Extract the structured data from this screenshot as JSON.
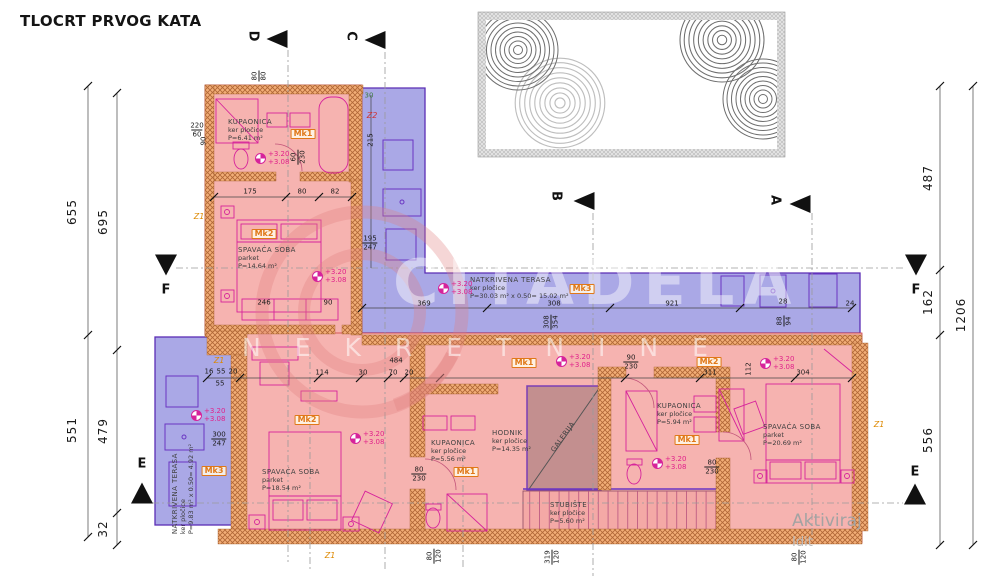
{
  "title": "TLOCRT PRVOG KATA",
  "watermark": {
    "brand": "CITADELA",
    "sub": "NEKRETNINE"
  },
  "activation": {
    "line1": "Aktiviraj",
    "line2": "Idit"
  },
  "elevation": {
    "top": "+3.20",
    "bottom": "+3.08"
  },
  "colors": {
    "room_fill": "#f6b3b0",
    "terrace_fill": "#aaa8e6",
    "wall_fill": "#f2ae77",
    "wall_line": "#b06636",
    "accent_magenta": "#d6239b",
    "accent_purple": "#6a35c2",
    "label_orange": "#e07818",
    "dim_green": "#3f7d3f",
    "gallery_fill": "#c38f8f"
  },
  "rooms": [
    {
      "x": 228,
      "y": 118,
      "lines": [
        "KUPAONICA",
        "ker pločice",
        "P=6.41 m²"
      ]
    },
    {
      "x": 238,
      "y": 246,
      "lines": [
        "SPAVAĆA SOBA",
        "parket",
        "P=14.64 m²"
      ]
    },
    {
      "x": 470,
      "y": 276,
      "lines": [
        "NATKRIVENA TERASA",
        "ker pločice",
        "P=30.03 m² x 0.50= 15.02 m²"
      ]
    },
    {
      "x": 183,
      "y": 489,
      "rot": -90,
      "anchor": "c",
      "lines": [
        "NATKRIVENA TERASA",
        "ker pločice",
        "P=9.83 m² x 0.50= 4.92 m²"
      ]
    },
    {
      "x": 262,
      "y": 468,
      "lines": [
        "SPAVAĆA SOBA",
        "parket",
        "P=18.54 m²"
      ]
    },
    {
      "x": 431,
      "y": 439,
      "lines": [
        "KUPAONICA",
        "ker pločice",
        "P=5.56 m²"
      ]
    },
    {
      "x": 492,
      "y": 429,
      "lines": [
        "HODNIK",
        "ker pločice",
        "P=14.35 m²"
      ]
    },
    {
      "x": 550,
      "y": 501,
      "lines": [
        "STUBIŠTE",
        "ker pločice",
        "P=5.60 m²"
      ]
    },
    {
      "x": 657,
      "y": 402,
      "lines": [
        "KUPAONICA",
        "ker pločice",
        "P=5.94 m²"
      ]
    },
    {
      "x": 763,
      "y": 423,
      "lines": [
        "SPAVAĆA SOBA",
        "parket",
        "P=20.69 m²"
      ]
    },
    {
      "x": 563,
      "y": 437,
      "rot": -54,
      "anchor": "c",
      "cls": "gal",
      "lines": [
        "GALERIJA"
      ]
    }
  ],
  "mk_labels": [
    {
      "t": "Mk1",
      "x": 303,
      "y": 134
    },
    {
      "t": "Mk2",
      "x": 264,
      "y": 234
    },
    {
      "t": "Mk3",
      "x": 582,
      "y": 289
    },
    {
      "t": "Mk3",
      "x": 214,
      "y": 471
    },
    {
      "t": "Mk2",
      "x": 307,
      "y": 420
    },
    {
      "t": "Mk1",
      "x": 466,
      "y": 472
    },
    {
      "t": "Mk1",
      "x": 524,
      "y": 363
    },
    {
      "t": "Mk1",
      "x": 687,
      "y": 440
    },
    {
      "t": "Mk2",
      "x": 709,
      "y": 362
    }
  ],
  "z_labels": [
    {
      "t": "Z1",
      "x": 199,
      "y": 217
    },
    {
      "t": "Z1",
      "x": 219,
      "y": 361
    },
    {
      "t": "Z1",
      "x": 330,
      "y": 556
    },
    {
      "t": "Z1",
      "x": 879,
      "y": 425
    },
    {
      "t": "Z2",
      "x": 372,
      "y": 116,
      "red": true
    }
  ],
  "elevations": [
    {
      "x": 255,
      "y": 150
    },
    {
      "x": 312,
      "y": 268
    },
    {
      "x": 438,
      "y": 280
    },
    {
      "x": 191,
      "y": 407
    },
    {
      "x": 350,
      "y": 430
    },
    {
      "x": 556,
      "y": 353
    },
    {
      "x": 652,
      "y": 455
    },
    {
      "x": 760,
      "y": 355
    }
  ],
  "section_markers": [
    {
      "letter": "D",
      "lx": 253,
      "ly": 36,
      "lrot": 90,
      "tx": 277,
      "ty": 39,
      "dir": "left"
    },
    {
      "letter": "C",
      "lx": 351,
      "ly": 36,
      "lrot": 90,
      "tx": 375,
      "ty": 40,
      "dir": "left"
    },
    {
      "letter": "B",
      "lx": 556,
      "ly": 196,
      "lrot": 90,
      "tx": 584,
      "ty": 201,
      "dir": "left"
    },
    {
      "letter": "A",
      "lx": 775,
      "ly": 200,
      "lrot": 90,
      "tx": 800,
      "ty": 204,
      "dir": "left"
    },
    {
      "letter": "F",
      "lx": 166,
      "ly": 290,
      "lrot": 0,
      "tx": 166,
      "ty": 265,
      "dir": "down"
    },
    {
      "letter": "F",
      "lx": 916,
      "ly": 290,
      "lrot": 0,
      "tx": 916,
      "ty": 265,
      "dir": "down"
    },
    {
      "letter": "E",
      "lx": 142,
      "ly": 464,
      "lrot": 0,
      "tx": 142,
      "ty": 493,
      "dir": "up"
    },
    {
      "letter": "E",
      "lx": 915,
      "ly": 472,
      "lrot": 0,
      "tx": 915,
      "ty": 494,
      "dir": "up"
    }
  ],
  "dim_labels": [
    {
      "t": "655",
      "x": 72,
      "y": 212
    },
    {
      "t": "695",
      "x": 103,
      "y": 222
    },
    {
      "t": "551",
      "x": 72,
      "y": 430
    },
    {
      "t": "479",
      "x": 103,
      "y": 431
    },
    {
      "t": "32",
      "x": 103,
      "y": 529
    },
    {
      "t": "487",
      "x": 928,
      "y": 178
    },
    {
      "t": "162",
      "x": 928,
      "y": 302
    },
    {
      "t": "556",
      "x": 928,
      "y": 440
    },
    {
      "t": "1206",
      "x": 961,
      "y": 315
    }
  ],
  "dims": [
    {
      "t": "175",
      "x": 250,
      "y": 192
    },
    {
      "t": "80",
      "x": 302,
      "y": 192
    },
    {
      "t": "82",
      "x": 335,
      "y": 192
    },
    {
      "t": "90",
      "x": 204,
      "y": 141,
      "rot": -90
    },
    {
      "t": "246",
      "x": 264,
      "y": 303
    },
    {
      "t": "90",
      "x": 328,
      "y": 303
    },
    {
      "t": "215",
      "x": 371,
      "y": 140,
      "rot": -90
    },
    {
      "t": "30",
      "x": 369,
      "y": 96,
      "g": true
    },
    {
      "t": "369",
      "x": 424,
      "y": 304
    },
    {
      "t": "308",
      "x": 554,
      "y": 304
    },
    {
      "t": "921",
      "x": 672,
      "y": 304
    },
    {
      "t": "28",
      "x": 783,
      "y": 302
    },
    {
      "t": "24",
      "x": 850,
      "y": 304
    },
    {
      "t": "16",
      "x": 209,
      "y": 372
    },
    {
      "t": "55",
      "x": 221,
      "y": 372
    },
    {
      "t": "20",
      "x": 233,
      "y": 372
    },
    {
      "t": "55",
      "x": 220,
      "y": 384
    },
    {
      "t": "114",
      "x": 322,
      "y": 373
    },
    {
      "t": "30",
      "x": 363,
      "y": 373
    },
    {
      "t": "70",
      "x": 393,
      "y": 373
    },
    {
      "t": "20",
      "x": 409,
      "y": 373
    },
    {
      "t": "484",
      "x": 396,
      "y": 361
    },
    {
      "t": "311",
      "x": 710,
      "y": 373
    },
    {
      "t": "304",
      "x": 803,
      "y": 373
    },
    {
      "t": "112",
      "x": 749,
      "y": 369,
      "rot": -90
    }
  ],
  "fracs": [
    {
      "t1": "220",
      "t2": "60",
      "x": 197,
      "y": 130
    },
    {
      "t1": "300",
      "t2": "247",
      "x": 219,
      "y": 439
    },
    {
      "t1": "195",
      "t2": "247",
      "x": 370,
      "y": 243
    },
    {
      "t1": "80",
      "t2": "230",
      "x": 419,
      "y": 474
    },
    {
      "t1": "90",
      "t2": "230",
      "x": 631,
      "y": 362
    },
    {
      "t1": "80",
      "t2": "230",
      "x": 712,
      "y": 467
    },
    {
      "t1": "60",
      "t2": "230",
      "x": 298,
      "y": 157,
      "rot": -90
    },
    {
      "t1": "308",
      "t2": "354",
      "x": 551,
      "y": 322,
      "rot": -90
    },
    {
      "t1": "88",
      "t2": "94",
      "x": 784,
      "y": 321,
      "rot": -90
    },
    {
      "t1": "80",
      "t2": "80",
      "x": 259,
      "y": 76,
      "rot": -90,
      "g": true
    },
    {
      "t1": "80",
      "t2": "120",
      "x": 434,
      "y": 556,
      "rot": -90,
      "g": true
    },
    {
      "t1": "319",
      "t2": "120",
      "x": 552,
      "y": 557,
      "rot": -90,
      "g": true
    },
    {
      "t1": "80",
      "t2": "120",
      "x": 799,
      "y": 557,
      "rot": -90,
      "g": true
    }
  ]
}
